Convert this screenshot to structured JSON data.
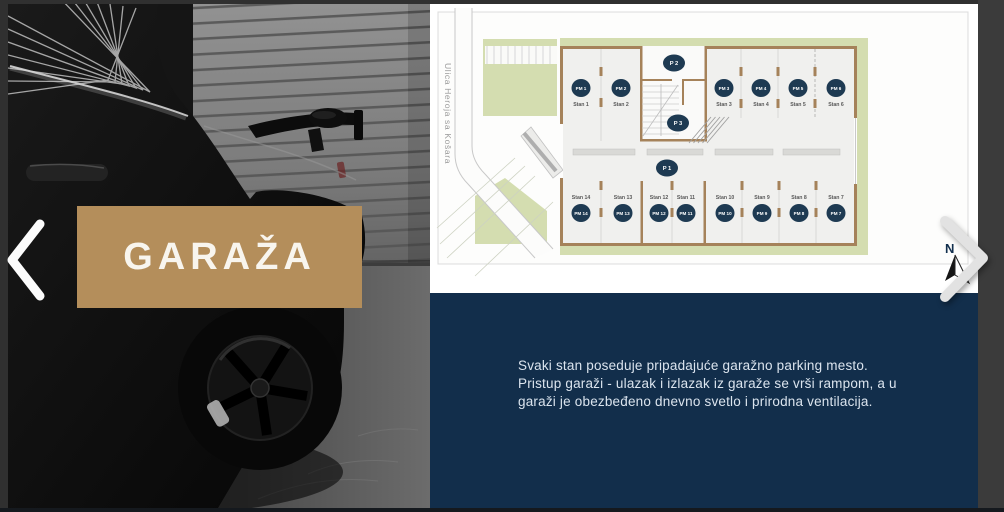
{
  "slide": {
    "title": "GARAŽA"
  },
  "navigation": {
    "prev_icon": "chevron-left",
    "next_icon": "chevron-right"
  },
  "floor_plan": {
    "street_label": "Ulica Heroja sa Košara",
    "north_label": "N",
    "zone_circles": [
      {
        "label": "P 2"
      },
      {
        "label": "P 3"
      },
      {
        "label": "P 1"
      }
    ],
    "top_spots": [
      {
        "pm": "PM 1",
        "stan": "Stan 1"
      },
      {
        "pm": "PM 2",
        "stan": "Stan 2"
      },
      {
        "pm": "PM 3",
        "stan": "Stan 3"
      },
      {
        "pm": "PM 4",
        "stan": "Stan 4"
      },
      {
        "pm": "PM 5",
        "stan": "Stan 5"
      },
      {
        "pm": "PM 6",
        "stan": "Stan 6"
      }
    ],
    "bottom_spots": [
      {
        "pm": "PM 14",
        "stan": "Stan 14"
      },
      {
        "pm": "PM 13",
        "stan": "Stan 13"
      },
      {
        "pm": "PM 12",
        "stan": "Stan 12"
      },
      {
        "pm": "PM 11",
        "stan": "Stan 11"
      },
      {
        "pm": "PM 10",
        "stan": "Stan 10"
      },
      {
        "pm": "PM 9",
        "stan": "Stan 9"
      },
      {
        "pm": "PM 8",
        "stan": "Stan 8"
      },
      {
        "pm": "PM 7",
        "stan": "Stan 7"
      }
    ]
  },
  "description": {
    "lines": [
      "Svaki stan poseduje pripadajuće garažno parking mesto.",
      "Pristup garaži - ulazak i izlazak iz garaže se vrši rampom, a u",
      "garaži je obezbeđeno dnevno svetlo i prirodna ventilacija."
    ]
  },
  "colors": {
    "accent_gold": "#b48e5b",
    "navy_background": "#122e4b",
    "parking_circle": "#1e3a52",
    "wall_tan": "#a5825a",
    "landscape_green": "#d4ddb0"
  }
}
